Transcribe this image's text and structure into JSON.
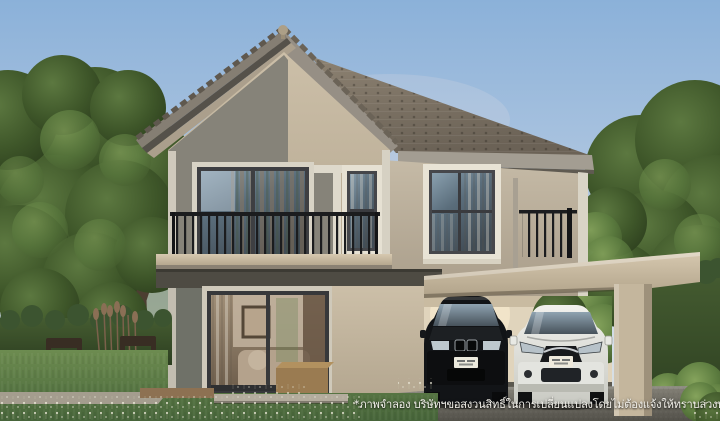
{
  "scene": {
    "type": "3d-architecture-render",
    "title": "Two-storey detached house with carport",
    "caption": {
      "text": "*ภาพจำลอง บริษัทฯขอสงวนสิทธิ์ในการเปลี่ยนแปลงโดยไม่ต้องแจ้งให้ทราบล่วงหน้า"
    },
    "house": {
      "storeys": 2,
      "elements": [
        "gable roof with ball finial",
        "hip tile roof",
        "second-floor balcony with black metal railing",
        "tall narrow window",
        "double sliding glass doors",
        "carport with flat roof",
        "roof-deck railing above carport"
      ]
    },
    "vehicles": [
      {
        "label": "black sedan",
        "body_color": "#121417"
      },
      {
        "label": "white compact car",
        "body_color": "#e9eae6"
      }
    ],
    "landscape": [
      "large tree on left",
      "large tree on right",
      "clipped hedges",
      "outdoor wooden chairs",
      "wooden cube side tables",
      "lawn with white wildflowers",
      "dark gravel driveway"
    ],
    "colors": {
      "sky_top": "#8bb1d9",
      "sky_horizon": "#dae0e5",
      "roof_tile": "#7d7265",
      "wall_beige": "#c6b8a2",
      "wall_grey": "#85827a",
      "wall_ground_floor": "#6e7066",
      "trim_white": "#ddd8cb",
      "railing_black": "#1b1c1e",
      "foliage": "#4a6636",
      "driveway": "#67655d",
      "caption_text": "#f2f0ea"
    }
  }
}
